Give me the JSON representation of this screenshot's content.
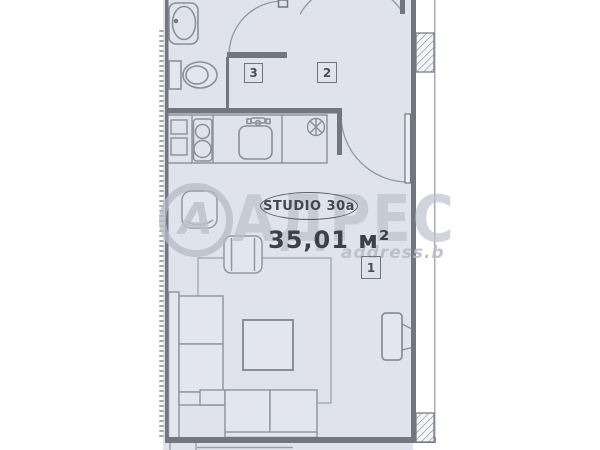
{
  "plan": {
    "unit": {
      "name": "STUDIO 30a",
      "area": "35,01 м²"
    },
    "room_numbers": {
      "living": "1",
      "hall": "2",
      "bathroom": "3"
    },
    "watermark": {
      "logo_letter": "А",
      "brand": "АДРЕС",
      "website": "address.b"
    },
    "colors": {
      "room_fill": "#e0e3ec",
      "wall": "#71767f",
      "furniture_line": "#9298a3",
      "fixture_line": "#8a909b",
      "dark_text": "#3c4048",
      "watermark": "#bbc0cb"
    }
  }
}
